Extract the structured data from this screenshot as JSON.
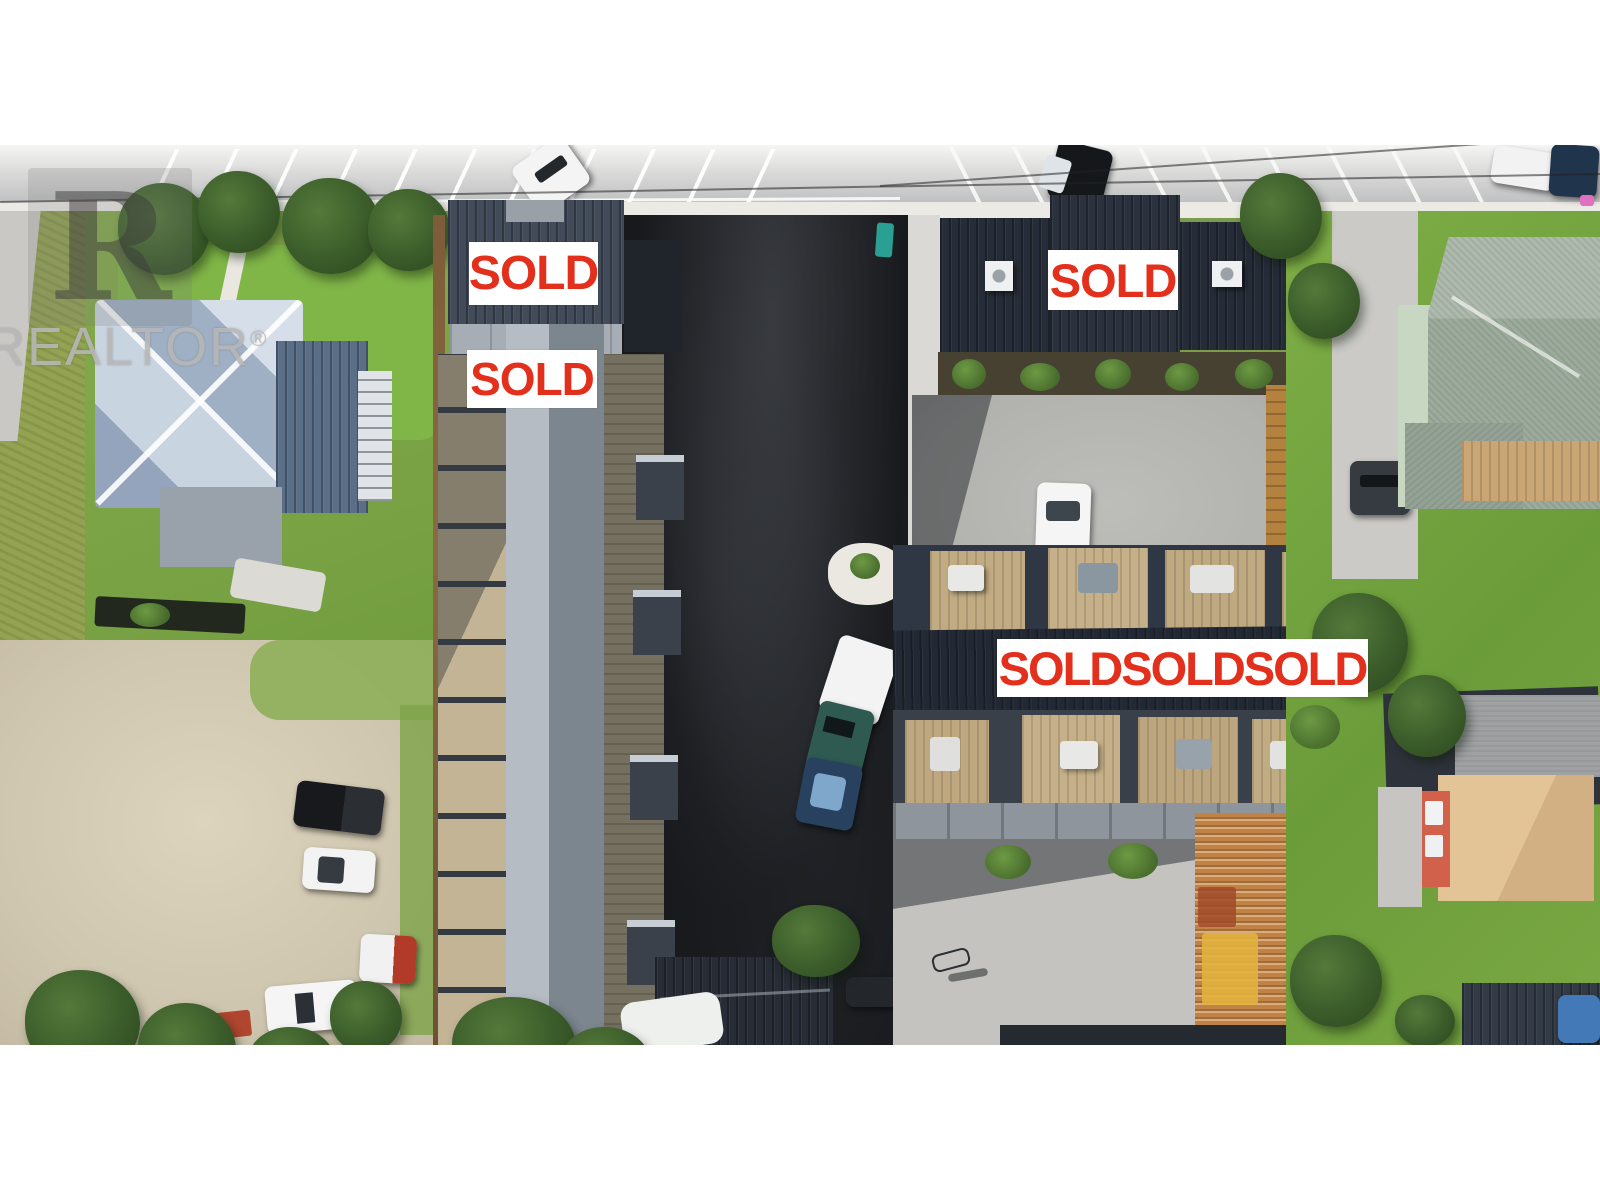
{
  "watermark": {
    "logo_letter": "R",
    "text": "REALTOR",
    "reg": "®",
    "color": "#b9b9b9"
  },
  "signs": {
    "bg_color": "#ffffff",
    "text_color": "#e2301c",
    "items": [
      {
        "label": "SOLD"
      },
      {
        "label": "SOLD"
      },
      {
        "label": "SOLD"
      },
      {
        "label": "SOLDSOLDSOLD"
      }
    ]
  }
}
